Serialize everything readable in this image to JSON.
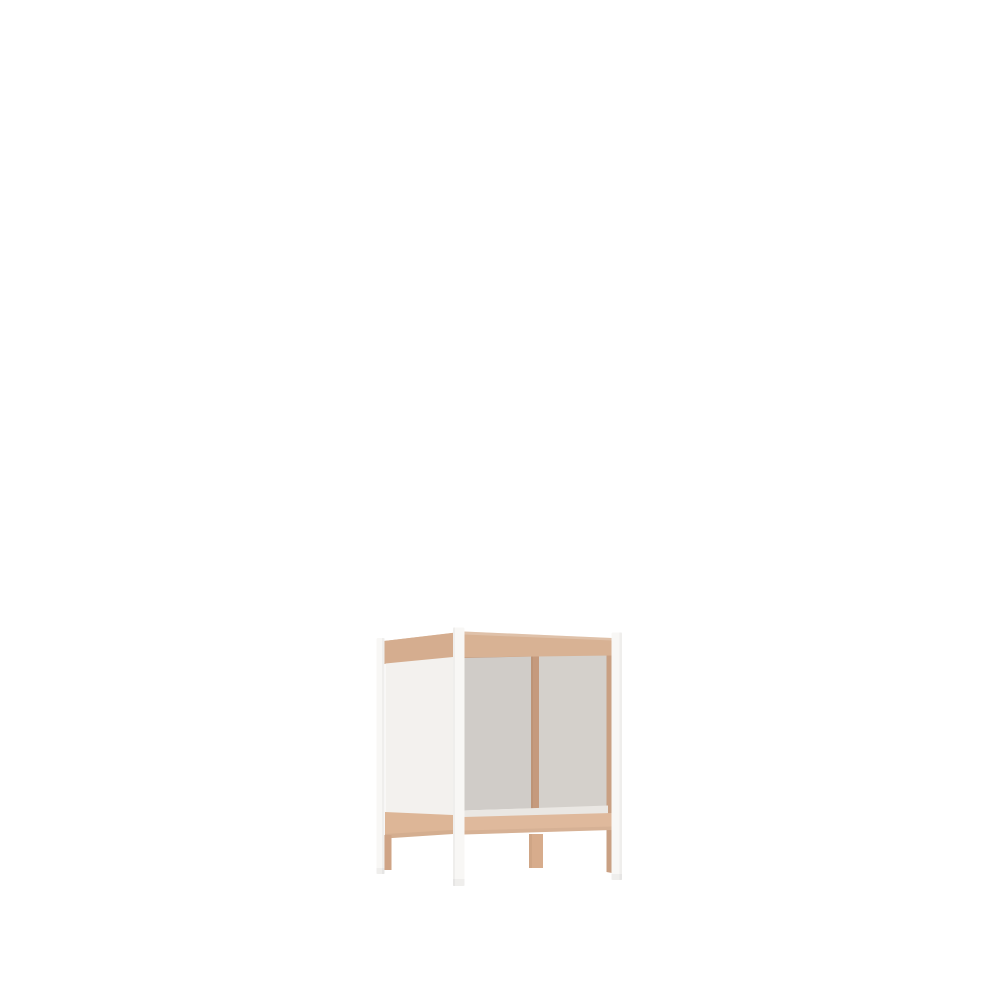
{
  "scene": {
    "type": "3d-product-render",
    "subject": "open-front cube side table / nightstand frame",
    "alt_text": "3D render of a small open-front side table with white corner posts, natural wood MDF rails, a middle wood back leg, a white left side panel and grey back panels, standing on a plain white background",
    "background_color": "#ffffff"
  },
  "colors": {
    "bg": "#ffffff",
    "wood-top": "#d8b294",
    "wood-left-rail": "#d5ad8f",
    "wood-inner": "#c99d7f",
    "wood-bottom": "#dfb99c",
    "wood-bottom-left": "#ddb697",
    "wood-divider": "#c59a7d",
    "wood-stile": "#c9a083",
    "wood-leg": "#d7ac8c",
    "wood-leg-dark": "#cfa486",
    "post-white": "#f8f7f5",
    "panel-white": "#f3f1ee",
    "panel-gray-left": "#d0ccc8",
    "panel-gray-right": "#d4d0cb",
    "inner-bottom": "#eae7e3"
  },
  "parts": {
    "posts": [
      "back-left-post",
      "front-left-post",
      "front-right-post"
    ],
    "wood_legs": [
      "back-left-wood-leg",
      "back-middle-wood-leg",
      "back-right-wood-leg"
    ],
    "panels": [
      "left-white-panel",
      "back-left-grey-panel",
      "back-right-grey-panel"
    ],
    "rails": [
      "top-front-rail",
      "top-left-rail",
      "back-top-rail",
      "bottom-front-rail",
      "bottom-left-rail"
    ],
    "divider": "back-middle-divider"
  }
}
